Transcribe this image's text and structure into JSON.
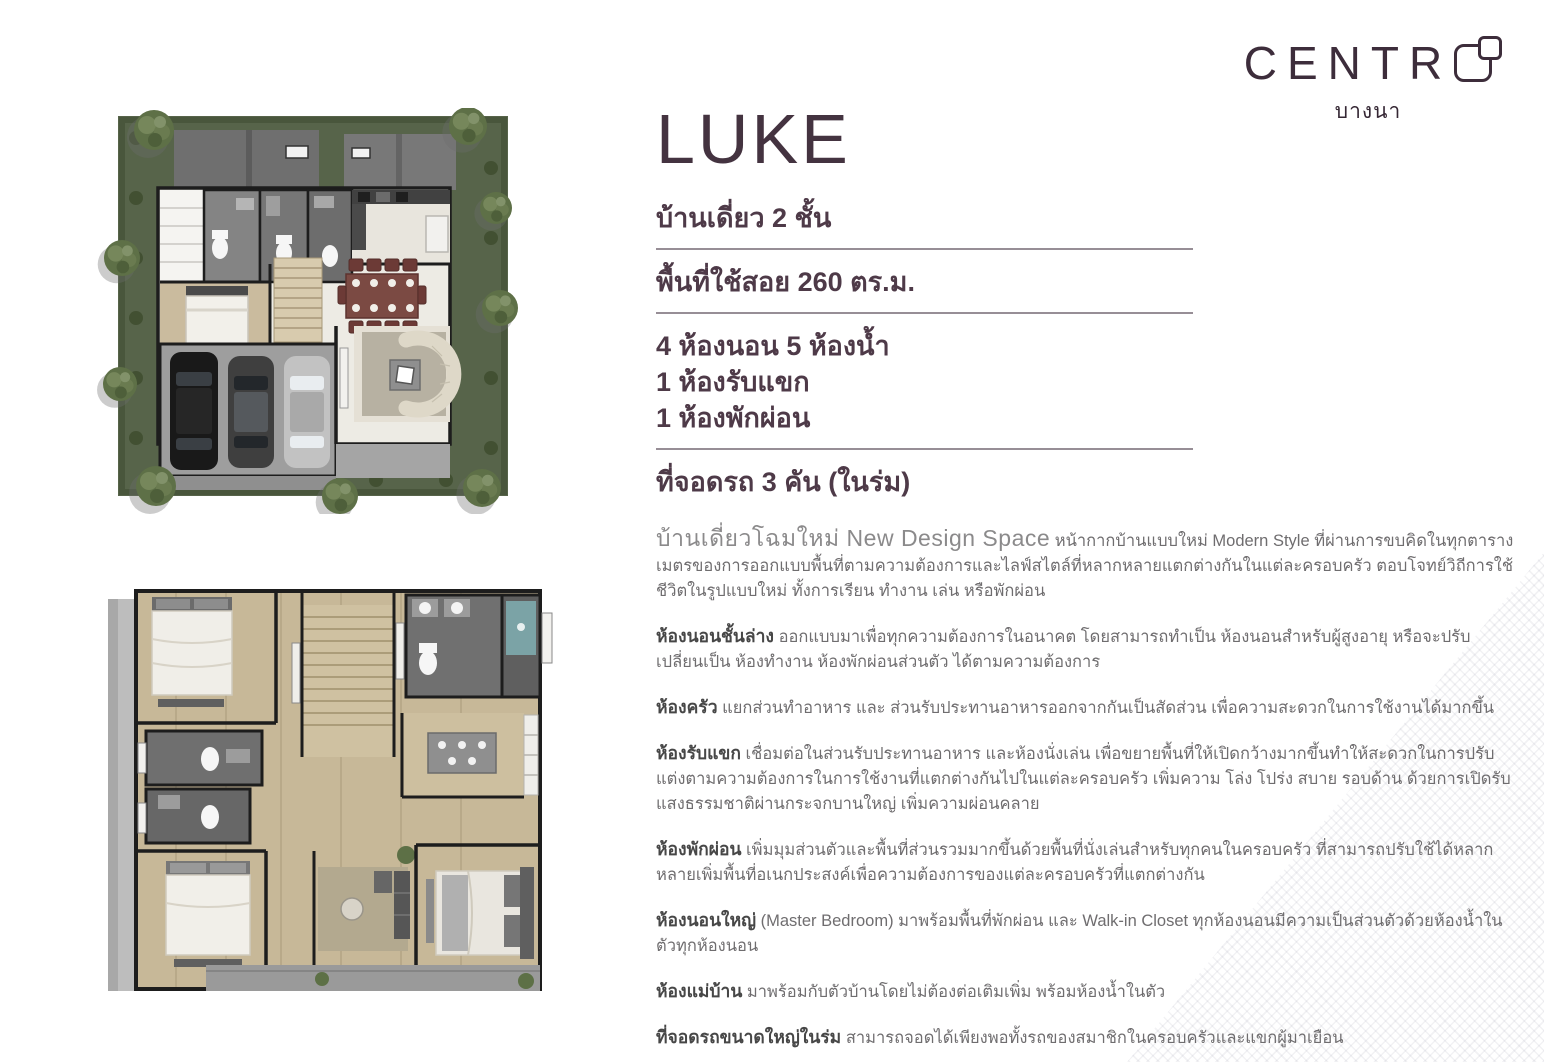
{
  "logo": {
    "brand_letters": "CENTR",
    "brand_o": "O",
    "location": "บางนา"
  },
  "model": {
    "name": "LUKE"
  },
  "specs": {
    "type_line": "บ้านเดี่ยว  2 ชั้น",
    "area_line": "พื้นที่ใช้สอย 260 ตร.ม.",
    "rooms_lines": [
      "4 ห้องนอน 5 ห้องน้ำ",
      "1 ห้องรับแขก",
      "1 ห้องพักผ่อน"
    ],
    "parking_line": "ที่จอดรถ 3 คัน (ในร่ม)"
  },
  "intro": {
    "lead": "บ้านเดี่ยวโฉมใหม่ New Design Space",
    "body": "หน้ากากบ้านแบบใหม่ Modern Style ที่ผ่านการขบคิดในทุกตารางเมตรของการออกแบบพื้นที่ตามความต้องการและไลฟ์สไตล์ที่หลากหลายแตกต่างกันในแต่ละครอบครัว ตอบโจทย์วิถีการใช้ชีวิตในรูปแบบใหม่ ทั้งการเรียน ทำงาน เล่น หรือพักผ่อน"
  },
  "paragraphs": [
    {
      "lead": "ห้องนอนชั้นล่าง",
      "body": "ออกแบบมาเพื่อทุกความต้องการในอนาคต โดยสามารถทำเป็น ห้องนอนสำหรับผู้สูงอายุ หรือจะปรับเปลี่ยนเป็น ห้องทำงาน ห้องพักผ่อนส่วนตัว ได้ตามความต้องการ"
    },
    {
      "lead": "ห้องครัว",
      "body": "แยกส่วนทำอาหาร และ ส่วนรับประทานอาหารออกจากกันเป็นสัดส่วน เพื่อความสะดวกในการใช้งานได้มากขึ้น"
    },
    {
      "lead": "ห้องรับแขก",
      "body": "เชื่อมต่อในส่วนรับประทานอาหาร และห้องนั่งเล่น เพื่อขยายพื้นที่ให้เปิดกว้างมากขึ้นทำให้สะดวกในการปรับแต่งตามความต้องการในการใช้งานที่แตกต่างกันไปในแต่ละครอบครัว เพิ่มความ โล่ง โปร่ง สบาย รอบด้าน ด้วยการเปิดรับแสงธรรมชาติผ่านกระจกบานใหญ่ เพิ่มความผ่อนคลาย"
    },
    {
      "lead": "ห้องพักผ่อน",
      "body": "เพิ่มมุมส่วนตัวและพื้นที่ส่วนรวมมากขึ้นด้วยพื้นที่นั่งเล่นสำหรับทุกคนในครอบครัว ที่สามารถปรับใช้ได้หลากหลายเพิ่มพื้นที่อเนกประสงค์เพื่อความต้องการของแต่ละครอบครัวที่แตกต่างกัน"
    },
    {
      "lead": "ห้องนอนใหญ่",
      "body": "(Master Bedroom) มาพร้อมพื้นที่พักผ่อน และ Walk-in Closet ทุกห้องนอนมีความเป็นส่วนตัวด้วยห้องน้ำในตัวทุกห้องนอน"
    },
    {
      "lead": "ห้องแม่บ้าน",
      "body": "มาพร้อมกับตัวบ้านโดยไม่ต้องต่อเติมเพิ่ม พร้อมห้องน้ำในตัว"
    },
    {
      "lead": "ที่จอดรถขนาดใหญ่ในร่ม",
      "body": "สามารถจอดได้เพียงพอทั้งรถของสมาชิกในครอบครัวและแขกผู้มาเยือน"
    }
  ],
  "colors": {
    "brand": "#3d2d3b",
    "heading": "#4e3a48",
    "body_text": "#6f6d6f",
    "separator": "#978e96",
    "lawn_green": "#57644a",
    "roof_gray": "#6f6f6f",
    "wood_floor": "#c7b898",
    "wall_black": "#1d1d1d",
    "dining_maroon": "#7b4a43"
  }
}
